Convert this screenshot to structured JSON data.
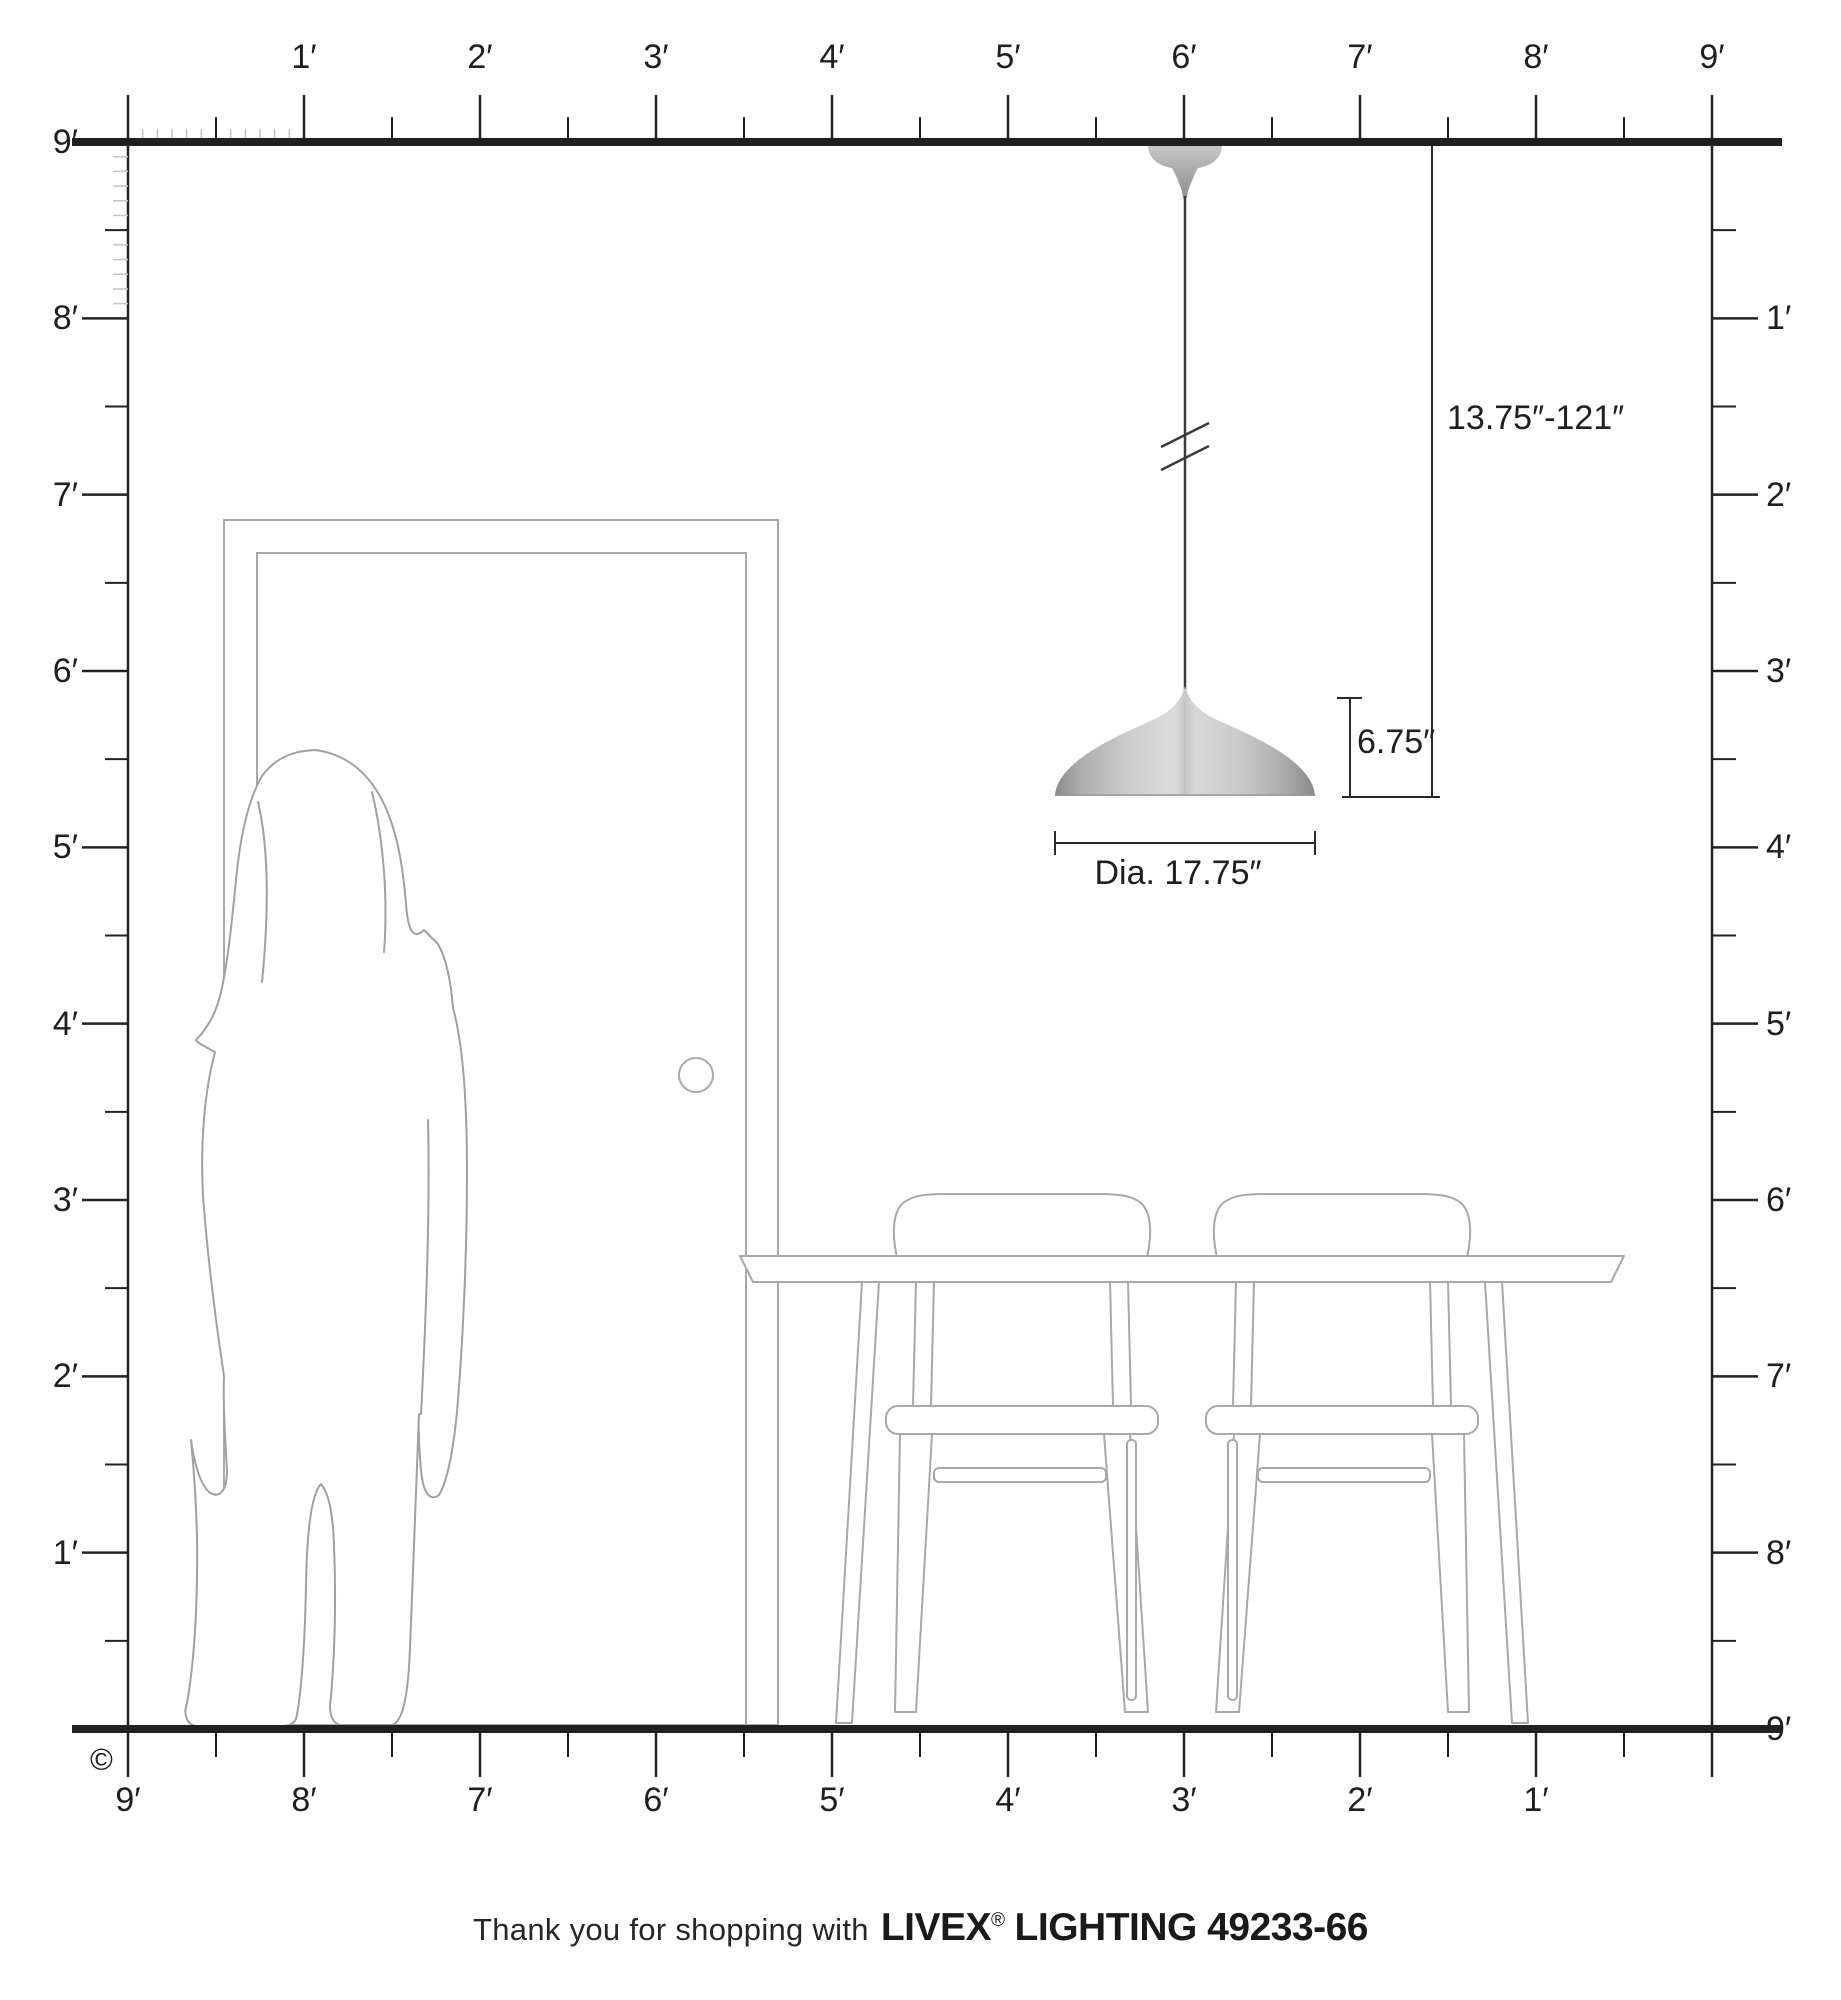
{
  "scene": {
    "feet": 9,
    "origin_x": 128,
    "right_wall_x": 1712,
    "ceiling_y": 142,
    "floor_y": 1729,
    "line_color": "#212121",
    "tick_color": "#222222",
    "inch_tick_color": "#c3c3c3",
    "structure_color": "#a8a8a8",
    "shade_edge_color": "#8d8d8d",
    "shade_center_color": "#dcdcdc"
  },
  "rulers": {
    "top": [
      "1′",
      "2′",
      "3′",
      "4′",
      "5′",
      "6′",
      "7′",
      "8′",
      "9′"
    ],
    "left": [
      "9′",
      "8′",
      "7′",
      "6′",
      "5′",
      "4′",
      "3′",
      "2′",
      "1′"
    ],
    "right": [
      "1′",
      "2′",
      "3′",
      "4′",
      "5′",
      "6′",
      "7′",
      "8′",
      "9′"
    ],
    "bottom": [
      "9′",
      "8′",
      "7′",
      "6′",
      "5′",
      "4′",
      "3′",
      "2′",
      "1′"
    ]
  },
  "annotations": {
    "hang_range": "13.75″-121″",
    "fixture_height": "6.75″",
    "diameter": "Dia. 17.75″"
  },
  "footer": {
    "thanks": "Thank you for shopping with",
    "brand": "LIVEX",
    "registered": "®",
    "product": "LIGHTING 49233-66"
  },
  "copyright": "©"
}
